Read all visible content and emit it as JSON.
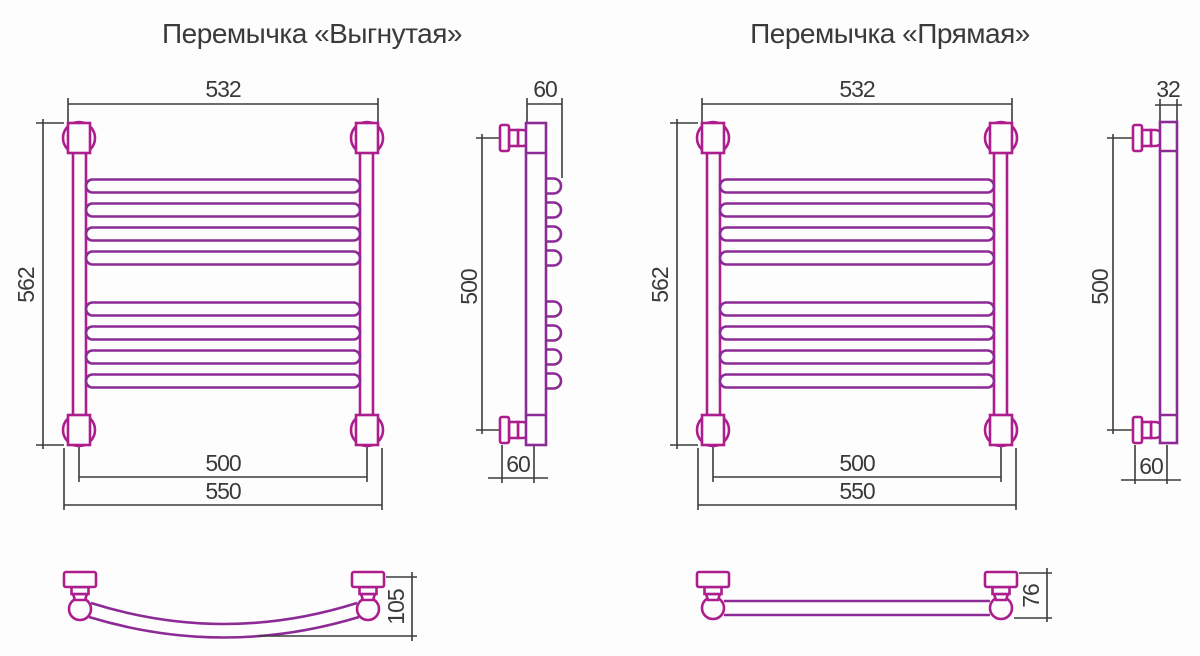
{
  "colors": {
    "product_pink": "#ad1d8d",
    "product_purple": "#8d2b96",
    "dimension_gray": "#3c3c3c",
    "background": "#fdfdfd"
  },
  "left_unit": {
    "title": "Перемычка «Выгнутая»",
    "front_view": {
      "width_top": "532",
      "height": "562",
      "width_inner": "500",
      "width_outer": "550"
    },
    "side_view": {
      "depth_top": "60",
      "height": "500",
      "depth_bottom": "60"
    },
    "bottom_view": {
      "depth": "105"
    }
  },
  "right_unit": {
    "title": "Перемычка «Прямая»",
    "front_view": {
      "width_top": "532",
      "height": "562",
      "width_inner": "500",
      "width_outer": "550"
    },
    "side_view": {
      "depth_top": "32",
      "height": "500",
      "depth_bottom": "60"
    },
    "bottom_view": {
      "depth": "76"
    }
  }
}
